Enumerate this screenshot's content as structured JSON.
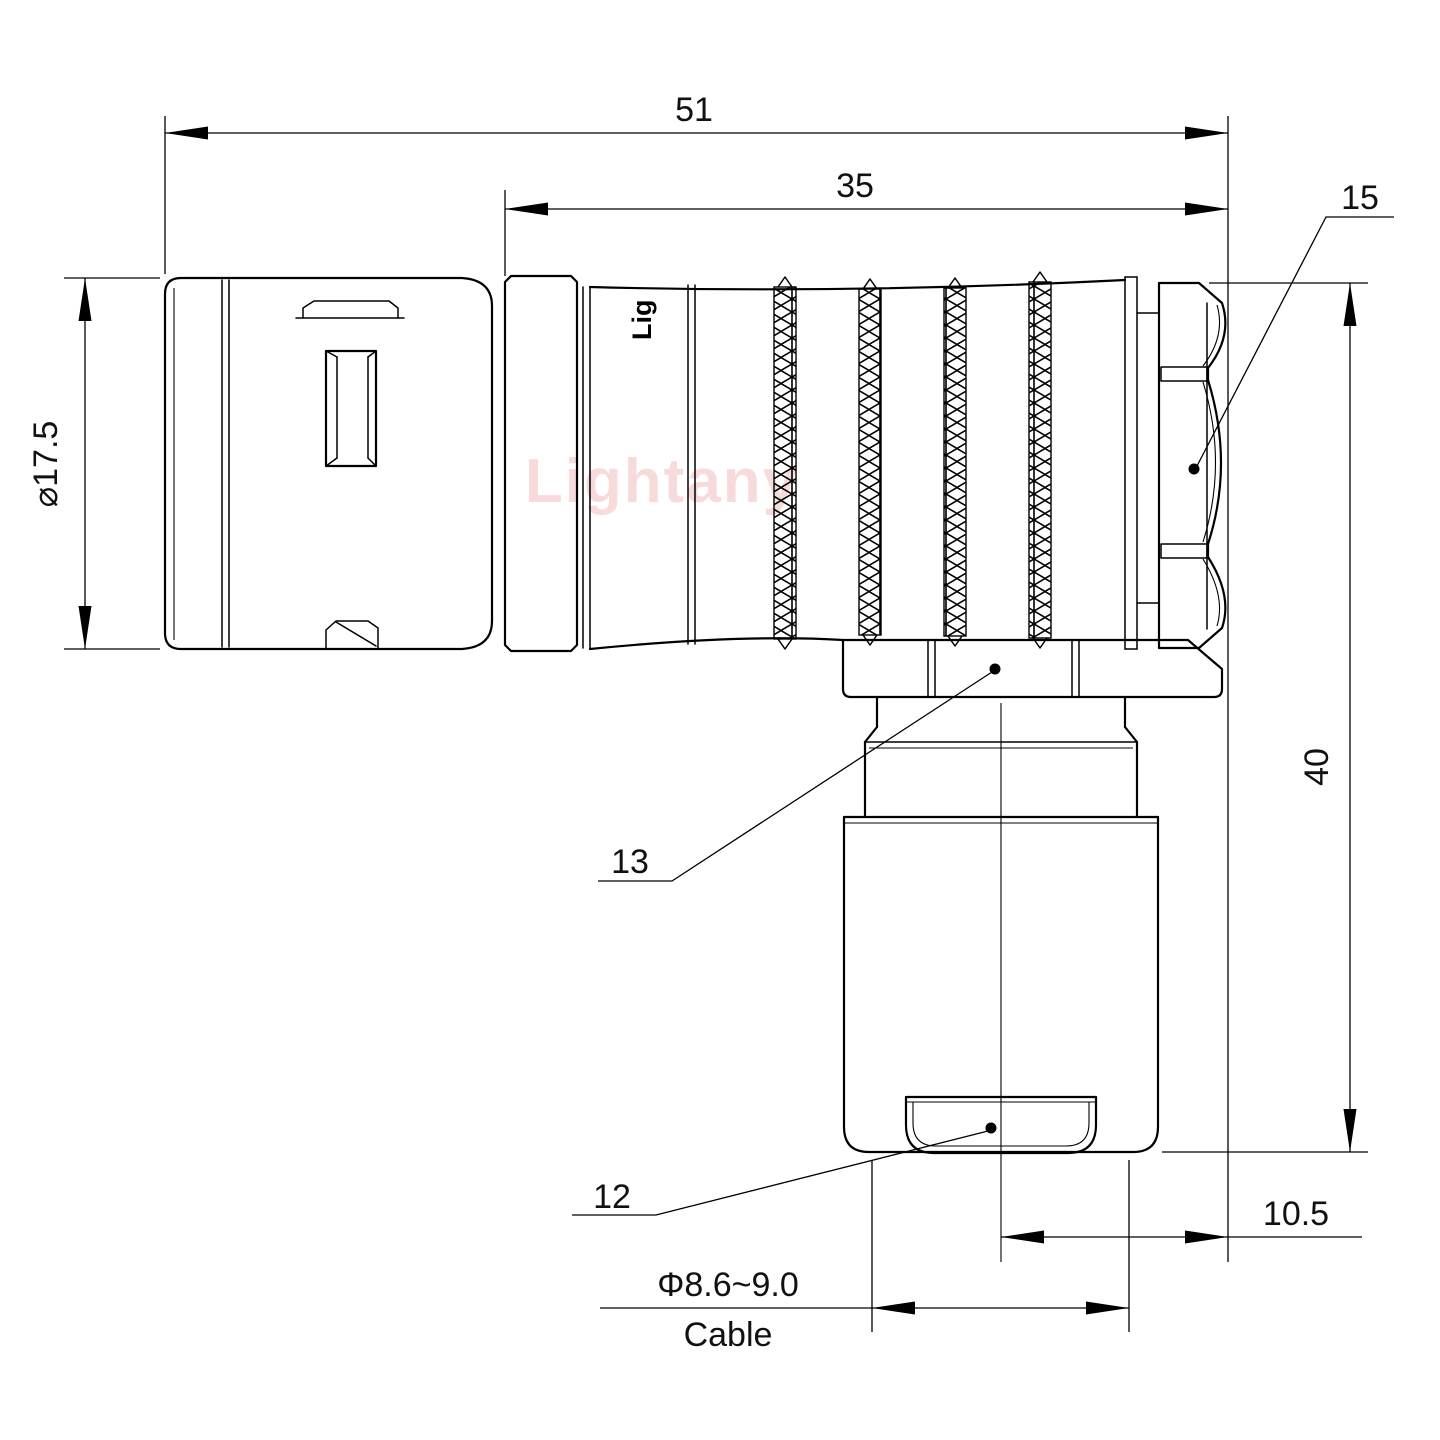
{
  "watermark": {
    "text": "Lightany",
    "color": "#f1bfbf"
  },
  "body_logo": {
    "text": "Lig"
  },
  "dimensions": {
    "overall_length": "51",
    "front_length": "35",
    "shell_diameter": "⌀17.5",
    "height": "40",
    "offset": "10.5",
    "cable_diameter": "Φ8.6~9.0",
    "cable_word": "Cable"
  },
  "labels": {
    "rear_nut": "15",
    "coupling_nut": "13",
    "cable_bushing": "12"
  },
  "colors": {
    "line": "#000000",
    "background": "#ffffff",
    "watermark": "#f1bfbf"
  }
}
